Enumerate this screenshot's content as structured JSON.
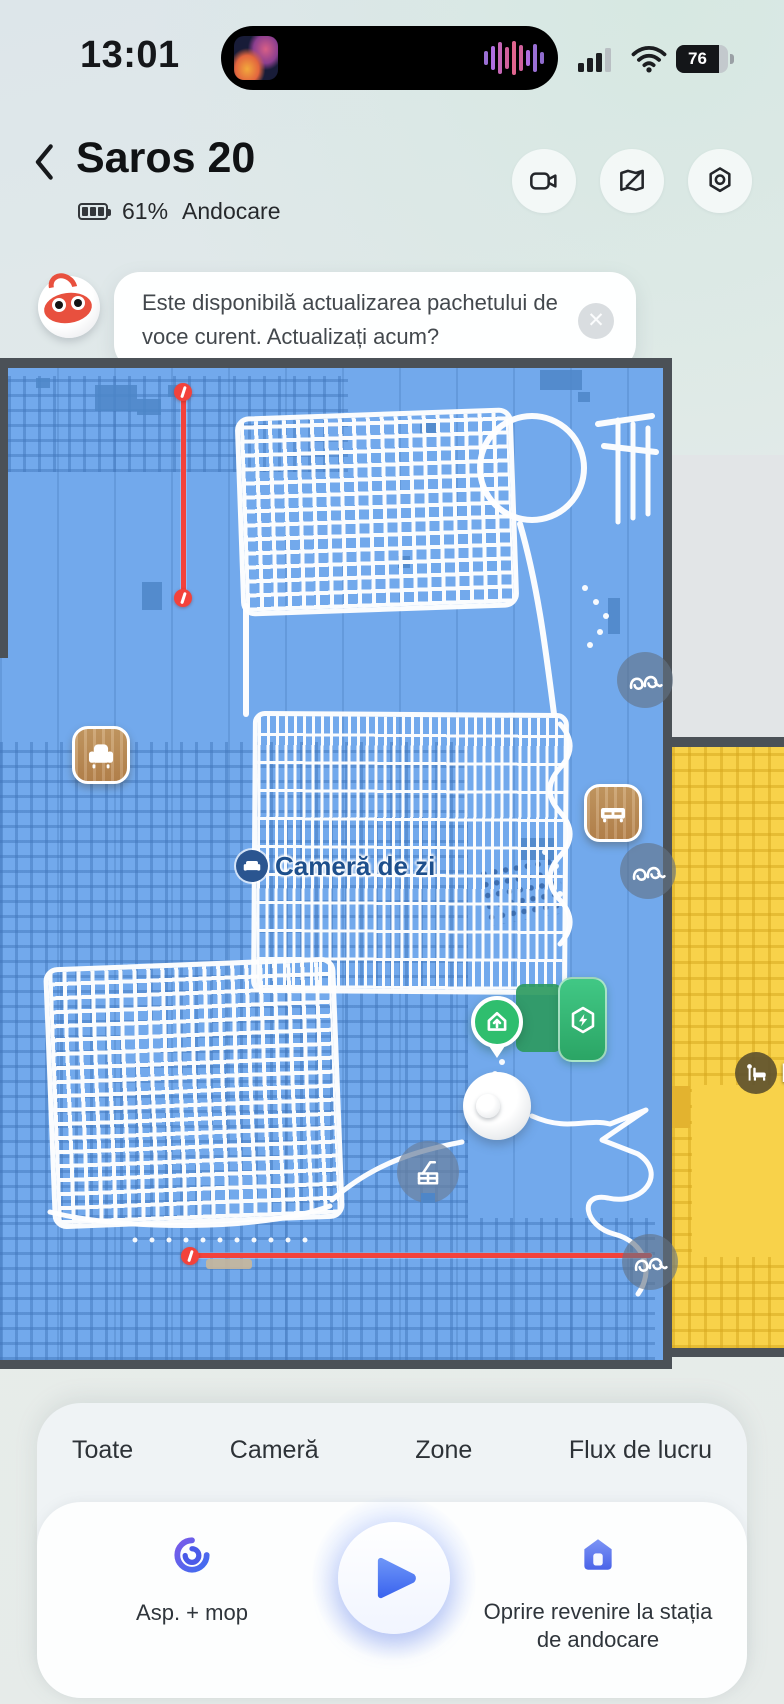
{
  "status_bar": {
    "time": "13:01",
    "battery_percent": "76",
    "icons": [
      "album-art",
      "audio-waveform",
      "cellular-signal",
      "wifi",
      "battery"
    ]
  },
  "header": {
    "back_icon": "chevron-left",
    "title": "Saros 20",
    "battery_level": "61%",
    "status_text": "Andocare",
    "actions": [
      {
        "icon": "video-camera"
      },
      {
        "icon": "map-edit"
      },
      {
        "icon": "settings-nut"
      }
    ]
  },
  "notification": {
    "mascot_icon": "robot-mascot",
    "message": "Este disponibilă actualizarea pachetului de voce curent. Actualizați acum?",
    "close_glyph": "✕"
  },
  "map": {
    "rooms": [
      {
        "name": "Cameră de zi",
        "icon": "sofa",
        "floor_color": "#72A9EC"
      },
      {
        "name": "D",
        "icon": "bed",
        "floor_color": "#F8D24A"
      }
    ],
    "markers": {
      "dock_pin_icon": "house-arrow-up",
      "dock_button_icon": "hexagon-lightning",
      "robot_icon": "robot-vacuum",
      "furniture": [
        {
          "type": "armchair"
        },
        {
          "type": "cabinet"
        }
      ],
      "obstacles": [
        {
          "type": "cable"
        },
        {
          "type": "cable"
        },
        {
          "type": "cable"
        },
        {
          "type": "chair"
        }
      ],
      "virtual_walls": [
        {
          "orientation": "vertical"
        },
        {
          "orientation": "horizontal"
        }
      ]
    }
  },
  "bottom_panel": {
    "tabs": [
      {
        "label": "Toate"
      },
      {
        "label": "Cameră"
      },
      {
        "label": "Zone"
      },
      {
        "label": "Flux de lucru"
      }
    ],
    "mode_button": {
      "icon": "suction-mop-swirl",
      "label": "Asp. + mop"
    },
    "play_button": {
      "icon": "play"
    },
    "dock_button": {
      "icon": "dock-house",
      "label": "Oprire revenire la stația de andocare"
    }
  },
  "colors": {
    "room_blue": "#72A9EC",
    "room_blue_grid": "rgba(62,115,184,0.45)",
    "room_yellow": "#F8D24A",
    "room_yellow_grid": "rgba(213,166,28,0.5)",
    "map_border": "#4B5157",
    "unexplored_gray": "#E2E5E7",
    "virtual_wall_red": "#F3423B",
    "dock_green": "#2FBE6E",
    "accent_blue": "#4F7BF3",
    "label_navy": "#1D4F8C"
  }
}
